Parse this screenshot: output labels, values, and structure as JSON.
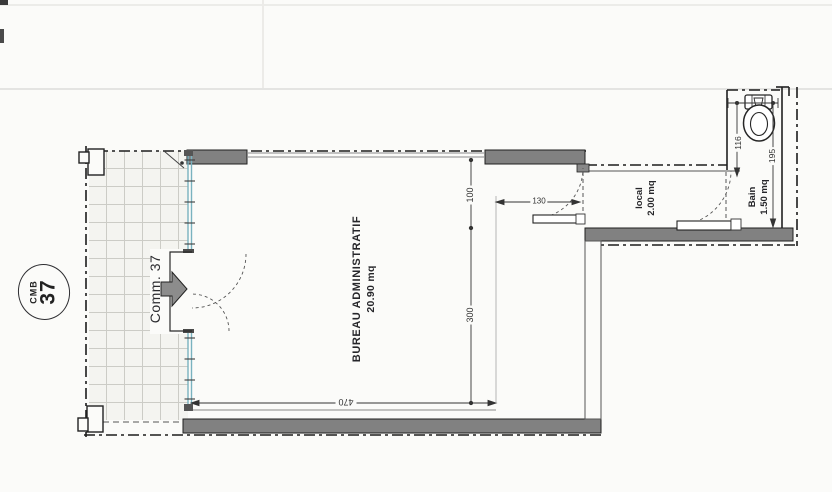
{
  "drawing": {
    "unit_badge": {
      "code": "CMB",
      "number": "37"
    },
    "entrance_label": "Comm. 37",
    "rooms": {
      "bureau": {
        "name": "BUREAU ADMINISTRATIF",
        "area": "20.90 mq"
      },
      "local": {
        "name": "local",
        "area": "2.00 mq"
      },
      "bain": {
        "name": "Bain",
        "area": "1.50 mq"
      }
    },
    "dimensions": {
      "upper_height": "100",
      "main_height": "300",
      "width": "470",
      "niche_width": "130",
      "bain_width": "116",
      "bain_depth": "195"
    },
    "icons": [
      "toilet-icon",
      "entry-arrow-icon"
    ],
    "colors": {
      "wall_fill": "#818181",
      "glazing": "#79b2bf",
      "line": "#1c1c1c"
    }
  }
}
